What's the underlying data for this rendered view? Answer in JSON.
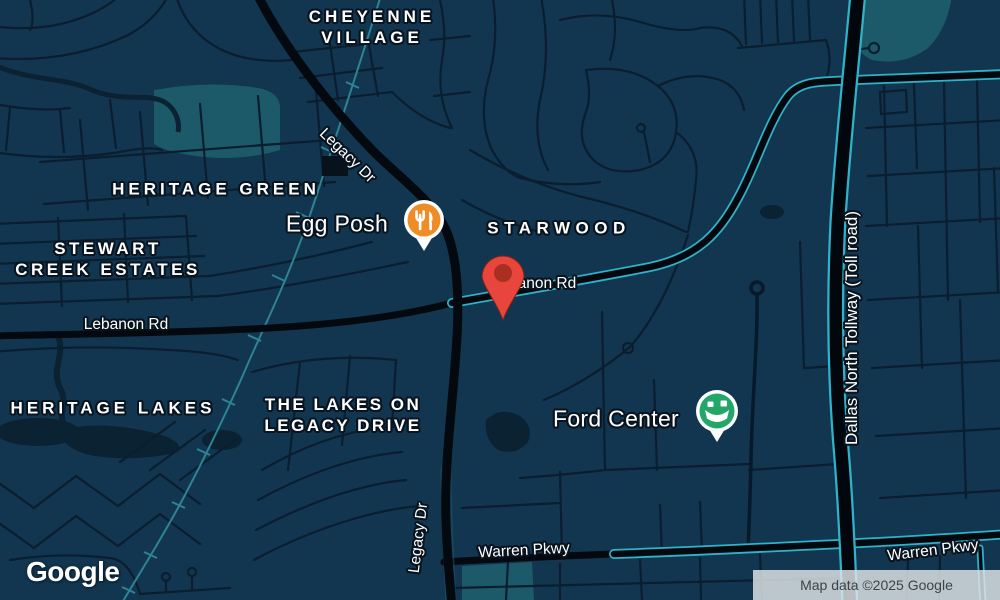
{
  "map": {
    "logo": "Google",
    "attribution": "Map data ©2025 Google"
  },
  "neighborhoods": {
    "cheyenne_village": {
      "line1": "CHEYENNE",
      "line2": "VILLAGE"
    },
    "heritage_green": {
      "label": "HERITAGE GREEN"
    },
    "stewart_creek_estates": {
      "line1": "STEWART",
      "line2": "CREEK ESTATES"
    },
    "heritage_lakes": {
      "label": "HERITAGE LAKES"
    },
    "the_lakes_on_legacy_drive": {
      "line1": "THE LAKES ON",
      "line2": "LEGACY DRIVE"
    },
    "starwood": {
      "label": "STARWOOD"
    }
  },
  "roads": {
    "legacy_dr_north": "Legacy Dr",
    "legacy_dr_south": "Legacy Dr",
    "lebanon_rd_west": "Lebanon Rd",
    "lebanon_rd_east": "Lebanon Rd",
    "warren_pkwy_west": "Warren Pkwy",
    "warren_pkwy_east": "Warren Pkwy",
    "dallas_north_tollway": "Dallas North Tollway (Toll road)"
  },
  "pois": {
    "egg_posh": {
      "label": "Egg Posh",
      "icon": "restaurant-icon",
      "pin_color": "#EE8C25"
    },
    "ford_center": {
      "label": "Ford Center",
      "icon": "stadium-icon",
      "pin_color": "#23A768"
    }
  },
  "marker": {
    "color": "#E8453C"
  },
  "colors": {
    "background": "#123650",
    "road_major": "#04090F",
    "road_minor": "#0A1E2F",
    "highway_edge": "#2FB3C9",
    "railway": "#2E8394",
    "park": "#1D5A69",
    "water": "#0A2231",
    "label_text": "#FFFFFF",
    "attribution_bg": "#E2E6E9",
    "attribution_text": "#3E4447"
  }
}
